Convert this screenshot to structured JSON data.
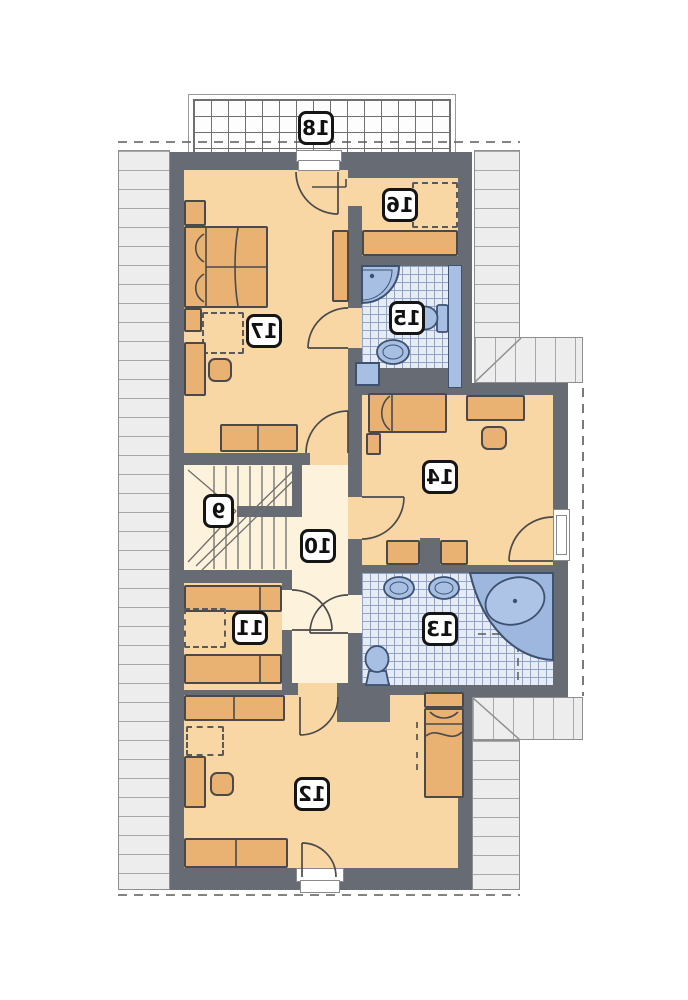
{
  "meta": {
    "drawing_type": "attic floor plan",
    "numbers_mirrored": true
  },
  "palette": {
    "wall": "#676c74",
    "floor": "#f8d7a4",
    "cream": "#fdf2dc",
    "furn": "#e9b273",
    "furnline": "#4a4a4a",
    "tilebg": "#e6ebf4",
    "tileline": "#93a5c7",
    "fixture": "#a6bfe2",
    "fixline": "#3d5270",
    "roofbg": "#ededed",
    "roofline": "#a8a8a8",
    "roofborder": "#8f8f8f",
    "dashc": "#5a5a5a"
  },
  "rooms": [
    {
      "id": "balcony",
      "label": "18"
    },
    {
      "id": "bedroom-17",
      "label": "17"
    },
    {
      "id": "room-16",
      "label": "16"
    },
    {
      "id": "bath-15",
      "label": "15"
    },
    {
      "id": "bedroom-14",
      "label": "14"
    },
    {
      "id": "stairs-9",
      "label": "9"
    },
    {
      "id": "hall-10",
      "label": "10"
    },
    {
      "id": "room-11",
      "label": "11"
    },
    {
      "id": "bath-13",
      "label": "13"
    },
    {
      "id": "bedroom-12",
      "label": "12"
    }
  ]
}
